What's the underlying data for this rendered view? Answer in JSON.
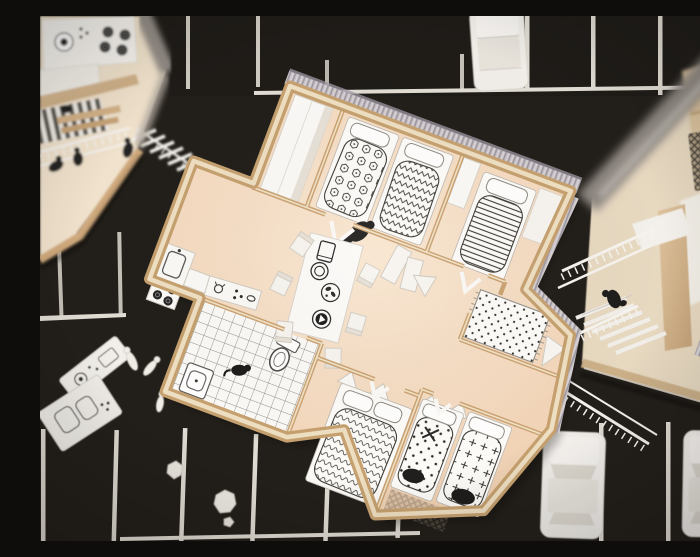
{
  "scene": {
    "type": "photograph",
    "description": "Top-down photograph of a cardboard architectural model: a furnished apartment floor plan with peach paper floors, plywood-edged walls and printed black-and-white furniture, placed on a black parking lot board with white stall stripes, paper cars, miniature figures and scattered model pieces.",
    "setting": "black asphalt parking-lot base with white painted parking stalls"
  },
  "palette": {
    "asphalt": "#1a1713",
    "stripe": "#e0dcd4",
    "floor_peach": "#f5dcc3",
    "plywood": "#c9a06f",
    "plywood_light": "#eedfc2",
    "model_white": "#f4f2ee",
    "ribbed_wall": "#c8c3c7",
    "pattern_ink": "#2f2d2b",
    "figure_black": "#1a1a1a"
  },
  "main_apartment": {
    "rotation_deg": 20.5,
    "rooms": [
      {
        "name": "entry-hall",
        "furniture": [
          "white wardrobe"
        ]
      },
      {
        "name": "kids-bedroom",
        "furniture": [
          "bed with hexagon-print duvet",
          "bed with chevron-print duvet",
          "pillows"
        ],
        "figures": [
          "black figure bending at bed foot"
        ]
      },
      {
        "name": "bedroom-striped",
        "furniture": [
          "bed with striped duvet",
          "closet"
        ]
      },
      {
        "name": "lounge-alcove",
        "furniture": [
          "polka-dot fringed rug",
          "white lounge chairs"
        ]
      },
      {
        "name": "living-dining",
        "furniture": [
          "white dining table printed with tablet, plate, bowl and record",
          "six white chairs",
          "folding screens"
        ]
      },
      {
        "name": "kitchen",
        "furniture": [
          "sink counter",
          "four-burner stove",
          "counter with cat bowls doodle"
        ]
      },
      {
        "name": "bathroom",
        "furniture": [
          "checker tile floor",
          "toilet",
          "washbasin"
        ],
        "figures": [
          "black cat"
        ]
      },
      {
        "name": "bedroom-wavy",
        "furniture": [
          "bed with wavy-print duvet",
          "A-frame stools"
        ]
      },
      {
        "name": "bedroom-double",
        "furniture": [
          "single bed with dot print and X mark",
          "single bed with cross print",
          "dark floor mat"
        ]
      }
    ]
  },
  "left_building": {
    "visible": "partial, top-left corner",
    "elements": [
      "kitchen counter with washer and four-burner stove",
      "striped interior stair",
      "wood decking strips",
      "white balcony railing",
      "three black figures",
      "white exterior stair"
    ]
  },
  "right_building": {
    "visible": "partial, right edge",
    "elements": [
      "blurred grey wall edge",
      "plywood roof panels",
      "cross-hatched panel",
      "white exterior stair with railings",
      "black figure sitting on stair",
      "plywood base edge"
    ]
  },
  "parking": {
    "cars": [
      {
        "position": "top-right stall",
        "color": "white paper"
      },
      {
        "position": "bottom-right stall 1",
        "color": "white paper"
      },
      {
        "position": "bottom-right stall 2, cropped by frame",
        "color": "white paper"
      }
    ],
    "scattered_items": [
      "white appliance cutout with dial drawing",
      "white cutout with burner drawings",
      "white miniature figures lying down",
      "crumpled paper scraps"
    ],
    "stall_stripe_color": "#e0dcd4"
  }
}
